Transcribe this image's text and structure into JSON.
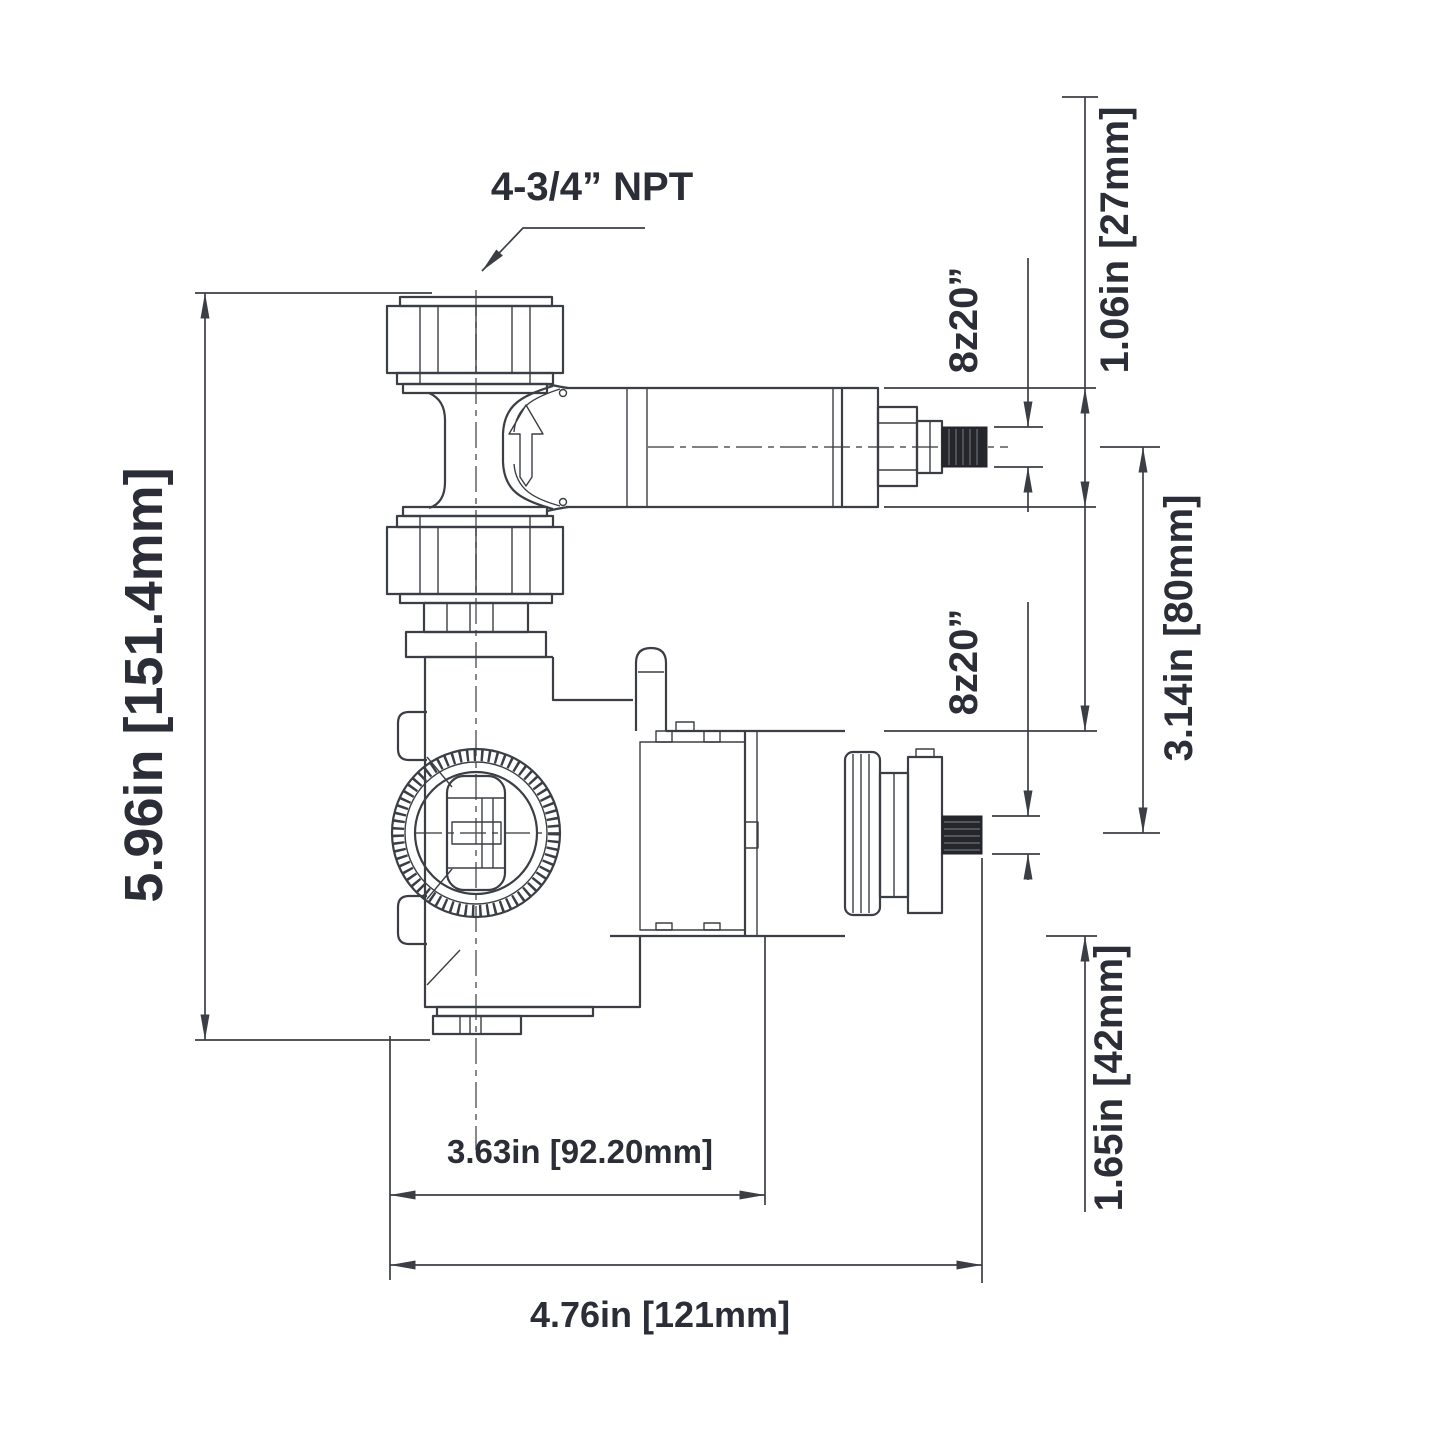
{
  "labels": {
    "npt_callout": "4-3/4” NPT",
    "overall_height": "5.96in [151.4mm]",
    "pipe_od": "1.06in [27mm]",
    "spline_top": "8z20”",
    "spline_bottom": "8z20”",
    "stem_spacing": "3.14in [80mm]",
    "valve_od": "1.65in [42mm]",
    "body_depth": "3.63in [92.20mm]",
    "overall_depth": "4.76in [121mm]"
  }
}
